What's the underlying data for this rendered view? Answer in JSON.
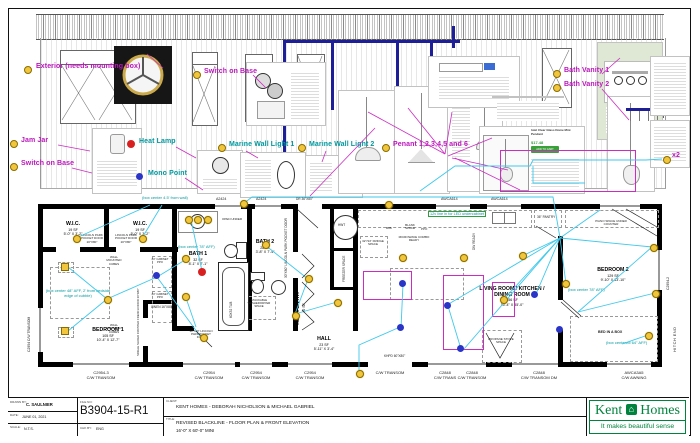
{
  "colors": {
    "magenta": "#bb16bb",
    "teal": "#00989e",
    "green": "#2f9e3f",
    "cyan": "#3ec9ec",
    "navy": "#1e1e96",
    "yellow": "#f2c63c",
    "red": "#d92020",
    "blue": "#2a35c8",
    "kent_green": "#00843d"
  },
  "callouts": {
    "exterior": "Exterior (needs mounting box)",
    "switch_on_base_mid": "Switch on Base",
    "bath_vanity_1": "Bath Vanity 1",
    "bath_vanity_2": "Bath Vanity 2",
    "jam_jar": "Jam Jar",
    "heat_lamp": "Heat Lamp",
    "switch_on_base_left": "Switch on Base",
    "mono_point": "Mono Point",
    "marine_wall_light_1": "Marine Wall Light 1",
    "marine_wall_light_2": "Marine Wall Light 2",
    "pendants": "Penant 1,2,3,4,5 and 6",
    "x2": "x2"
  },
  "product_listing": {
    "title": "Iolet Clear Glass Dome Mini Pendant",
    "price": "$17.48",
    "button": "ADD TO CART"
  },
  "annotations": {
    "box_wall": "(box center 4.5' from wall)",
    "box_78_bath": "(box center 78\" AFF)",
    "box_48_bed": "(box center 48\" AFF, 2' from bedside edge of cubbie)",
    "led_undercab": "12v line in for LED undercabinet",
    "box_78_bed2": "(box center 78\" AFF)",
    "box_64": "(box centered 64\" AFF)"
  },
  "rooms": [
    {
      "name": "W.I.C.",
      "area": "19 SF",
      "dims": "5'-0\" X 3'-2\""
    },
    {
      "name": "W.I.C.",
      "area": "19 SF",
      "dims": "5'-0\" X 3'-2\""
    },
    {
      "name": "BATH 1",
      "area": "32 SF",
      "dims": "8'-1\" X 7'-1\""
    },
    {
      "name": "BEDROOM 1",
      "area": "105 SF",
      "dims": "10'-4\" X 12'-7\""
    },
    {
      "name": "BATH 2",
      "area": "28 SF",
      "dims": "3'-8\" X 7'-4\""
    },
    {
      "name": "REAR ENTRY",
      "area": "40 SF",
      "dims": ""
    },
    {
      "name": "HALL",
      "area": "23 SF",
      "dims": "5'-11\" X 3'-4\""
    },
    {
      "name": "LIVING ROOM / KITCHEN /",
      "name2": "DINING ROOM",
      "area": "556 SF",
      "dims": "15'-4\" X 35'-0\""
    },
    {
      "name": "BEDROOM 2",
      "area": "129 SF",
      "dims": "9'-10\" X 13'-10\""
    }
  ],
  "notes": {
    "wall_cubes": "WALL MOUNTED CUBES",
    "pocket_door_20": "LINCOLN PARK POCKET DOOR 20\"X80\"",
    "pocket_door_30": "30\"X80\" LINCOLN PARK POCKET DOOR",
    "linen": "LINEN 16\"X80\"",
    "french_door": "SINGLE SLIDER FROSTED FRENCH DOOR 30\"X80\"",
    "cabinet_ppo": "24\" CABINET PPO",
    "washer": "STACKABLE WASHER/DRYER SPACE",
    "freezer": "FREEZER SPACE",
    "hwt": "HWT",
    "bib": "BI/B",
    "blank": "BLANK SPACE",
    "ppo": "PPO",
    "microwave": "MICROWAVE COMBO READY",
    "fridge": "32\"/34\" FRIDGE SPACE",
    "dw": "DW READY",
    "pantry": "36\" PANTRY",
    "open_under": "OPEN UNDER",
    "tub": "60X32 TUB",
    "propane": "PROPANE STOVE SPACE",
    "piano": "PIANO SPACE UNDER COUNTER",
    "bed_in_box": "BED IN A BOX",
    "khpd": "KHPD 60\"X80\"",
    "rear_door": "DR 36\"X80\"",
    "hitch": "HITCH END"
  },
  "windows": {
    "top": [
      "A2424",
      "A2424",
      "AWCA614",
      "AWCA614"
    ],
    "bottom": [
      {
        "code": "C2954-3",
        "sub": "C/W TRANSOM"
      },
      {
        "code": "C2954",
        "sub": "C/W TRANSOM"
      },
      {
        "code": "C2954",
        "sub": "C/W TRANSOM"
      },
      {
        "code": "C2954",
        "sub": "C/W TRANSOM"
      },
      {
        "code": "",
        "sub": "C/W TRANSOM"
      },
      {
        "code": "C2848",
        "sub": "C/W TRANS"
      },
      {
        "code": "C2848",
        "sub": "C/W TRANSOM"
      },
      {
        "code": "C2848",
        "sub": "C/W TRANSOM DM"
      },
      {
        "code": "AWCA3A5",
        "sub": "C/W AWNING"
      }
    ],
    "left": "C2954 C/W TRANSOM",
    "right": "C2954-2"
  },
  "titleblock": {
    "drawn_by_label": "DRAWN BY:",
    "drawn_by": "C. SAULNIER",
    "date_label": "DATE:",
    "date": "JUNE 01, 2021",
    "scale_label": "SCALE:",
    "scale": "N.T.S.",
    "file_label": "FILE NO:",
    "file_no": "B3904-15-R1",
    "chk_label": "CHK BY:",
    "chk": "ENG",
    "client_label": "CLIENT:",
    "client": "KENT HOMES - DEBORAH NICHOLSON & MICHAEL GABRIEL",
    "title_label": "TITLE:",
    "title1": "REVISED BLACKLINE - FLOOR PLAN & FRONT ELEVATION",
    "title2": "16'-0\" X 60'-0\" MINI"
  },
  "logo": {
    "brand1": "Kent",
    "brand2": "Homes",
    "house": "⌂",
    "tagline": "It makes beautiful sense"
  }
}
